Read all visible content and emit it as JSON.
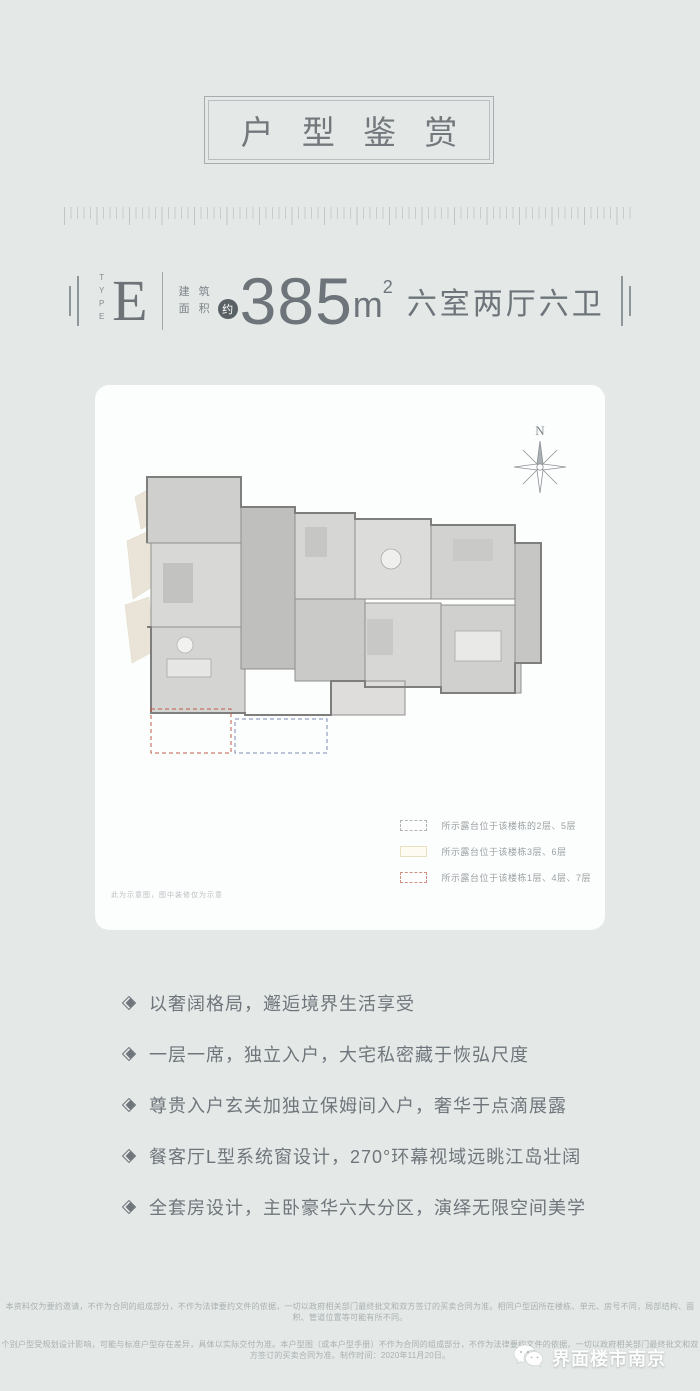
{
  "header": {
    "title": "户 型 鉴 赏"
  },
  "spec": {
    "type_label": "TYPE",
    "type_value": "E",
    "area_label_line1": "建 筑",
    "area_label_line2": "面 积",
    "approx_badge": "约",
    "area_value": "385",
    "area_unit": "m",
    "area_exponent": "2",
    "layout_text": "六室两厅六卫"
  },
  "floorplan_card": {
    "compass_label": "N",
    "note": "此为示意图，图中装修仅为示意",
    "legend": [
      {
        "style": "dashed-grey",
        "label": "所示露台位于该楼栋的2层、5层"
      },
      {
        "style": "solid-yellow",
        "label": "所示露台位于该楼栋3层、6层"
      },
      {
        "style": "dashed-red",
        "label": "所示露台位于该楼栋1层、4层、7层"
      }
    ]
  },
  "features": [
    "以奢阔格局，邂逅境界生活享受",
    "一层一席，独立入户，大宅私密藏于恢弘尺度",
    "尊贵入户玄关加独立保姆间入户，奢华于点滴展露",
    "餐客厅L型系统窗设计，270°环幕视域远眺江岛壮阔",
    "全套房设计，主卧豪华六大分区，演绎无限空间美学"
  ],
  "disclaimer": {
    "line1": "本资料仅为要约邀请，不作为合同的组成部分，不作为法律要约文件的依据，一切以政府相关部门最终批文和双方签订的买卖合同为准。相同户型因所在楼栋、单元、房号不同，局部结构、面积、管道位置等可能有所不同。",
    "line2": "个别户型受规划设计影响，可能与标准户型存在差异，具体以实际交付为准。本户型图（或本户型手册）不作为合同的组成部分，不作为法律要约文件的依据，一切以政府相关部门最终批文和双方签订的买卖合同为准。制作时间：2020年11月20日。"
  },
  "watermark": {
    "label": "界面楼市南京",
    "icon": "wechat-icon"
  },
  "colors": {
    "background": "#e4e8e7",
    "card": "#fcfdfd",
    "text_primary": "#6d747a",
    "text_muted": "#9aa1a3",
    "badge_bg": "#5a6165",
    "legend_dashed_grey": "#b3b5b2",
    "legend_solid_yellow": "#e9e0bd",
    "legend_dashed_red": "#cf9282",
    "plan_dashed_red": "#bf5a45",
    "plan_dashed_blue": "#7b8ab8",
    "plan_terrace_beige": "#d8cdb2"
  }
}
